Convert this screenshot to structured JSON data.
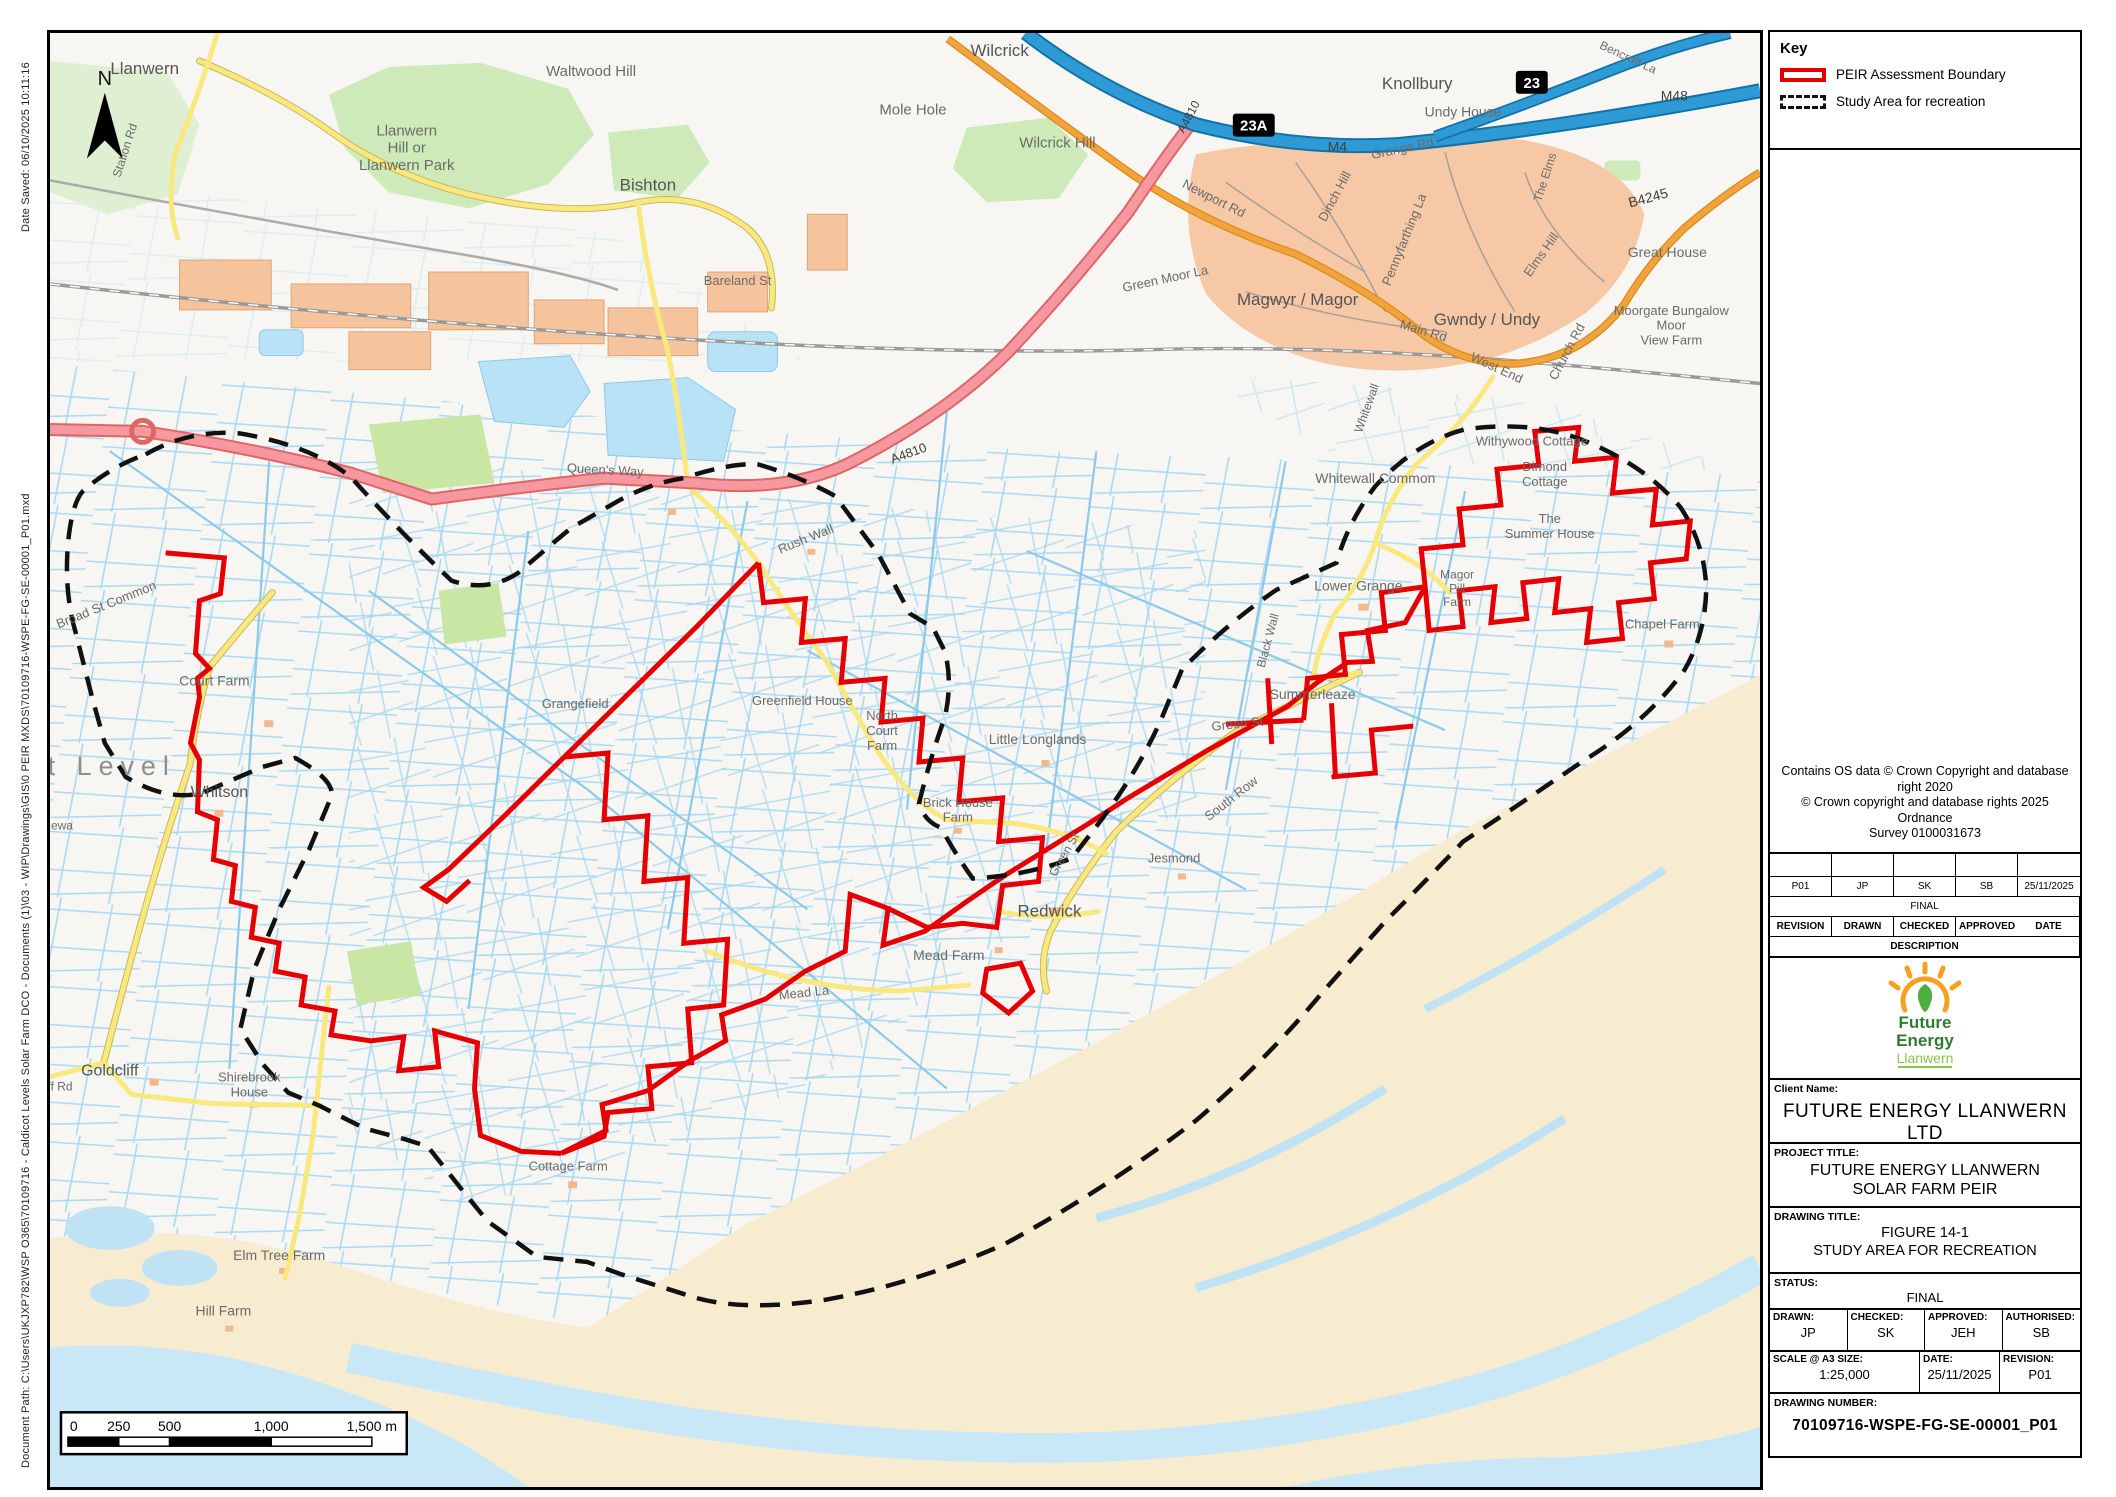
{
  "page": {
    "date_saved": "Date Saved: 06/10/2025 10:11:16",
    "document_path": "Document Path: C:\\Users\\UKJXP782\\WSP O365\\70109716 - Caldicot Levels Solar Farm DCO - Documents (1)\\03 - WIP\\Drawings\\GIS\\0 PEIR MXDS\\70109716-WSPE-FG-SE-00001_P01.mxd"
  },
  "north": "N",
  "key": {
    "title": "Key",
    "items": [
      {
        "label": "PEIR Assessment Boundary",
        "swatch": "red-solid"
      },
      {
        "label": "Study Area for recreation",
        "swatch": "black-dashed"
      }
    ]
  },
  "copyright": "Contains OS data © Crown Copyright and database\nright 2020\n© Crown copyright and database rights 2025 Ordnance\nSurvey 0100031673",
  "revision_table": {
    "empty_row": [
      "",
      "",
      "",
      "",
      ""
    ],
    "data_row": [
      "P01",
      "JP",
      "SK",
      "SB",
      "25/11/2025"
    ],
    "final_label": "FINAL",
    "headers": [
      "REVISION",
      "DRAWN",
      "CHECKED",
      "APPROVED",
      "DATE"
    ],
    "description_label": "DESCRIPTION"
  },
  "logo": {
    "line1": "Future",
    "line2": "Energy",
    "line3": "Llanwern"
  },
  "title_block": {
    "client_label": "Client Name:",
    "client_name": "FUTURE ENERGY LLANWERN LTD",
    "project_label": "PROJECT TITLE:",
    "project_title": "FUTURE ENERGY LLANWERN\nSOLAR FARM PEIR",
    "drawing_label": "DRAWING TITLE:",
    "drawing_title": "FIGURE 14-1\nSTUDY AREA FOR RECREATION",
    "status_label": "STATUS:",
    "status_value": "FINAL",
    "drawn_label": "DRAWN:",
    "drawn_value": "JP",
    "checked_label": "CHECKED:",
    "checked_value": "SK",
    "approved_label": "APPROVED:",
    "approved_value": "JEH",
    "authorised_label": "AUTHORISED:",
    "authorised_value": "SB",
    "scale_label": "SCALE @ A3 SIZE:",
    "scale_value": "1:25,000",
    "date_label": "DATE:",
    "date_value": "25/11/2025",
    "revision_label": "REVISION:",
    "revision_value": "P01",
    "drawing_number_label": "DRAWING NUMBER:",
    "drawing_number": "70109716-WSPE-FG-SE-00001_P01"
  },
  "scale_bar": {
    "ticks": [
      "0",
      "250",
      "500",
      "1,000",
      "1,500 m"
    ]
  },
  "colors": {
    "peir_boundary": "#e60004",
    "study_area": "#111111",
    "motorway": "#2e9bd6",
    "a_road": "#f598a0",
    "b_road": "#f2a33c",
    "minor_road": "#f9e87d",
    "water": "#a5d7f2",
    "sand": "#f8ecd0",
    "woodland": "#cdeab8",
    "builtup": "#f6c8a6"
  },
  "map": {
    "badges": [
      {
        "text": "23A",
        "x": 1208,
        "y": 93
      },
      {
        "text": "23",
        "x": 1487,
        "y": 50
      }
    ],
    "labels": [
      {
        "text": "Llanwern",
        "x": 95,
        "y": 41,
        "size": 17,
        "cls": "town"
      },
      {
        "text": "Station Rd",
        "x": 79,
        "y": 119,
        "size": 12,
        "rot": -72
      },
      {
        "text": "Waltwood Hill",
        "x": 543,
        "y": 43,
        "size": 15
      },
      {
        "text": "Llanwern\nHill or\nLlanwern Park",
        "x": 358,
        "y": 103,
        "size": 15
      },
      {
        "text": "Bishton",
        "x": 600,
        "y": 158,
        "size": 17,
        "cls": "town"
      },
      {
        "text": "Wilcrick",
        "x": 953,
        "y": 23,
        "size": 17,
        "cls": "town"
      },
      {
        "text": "Mole Hole",
        "x": 866,
        "y": 82,
        "size": 15
      },
      {
        "text": "Wilcrick Hill",
        "x": 1011,
        "y": 115,
        "size": 15
      },
      {
        "text": "Knollbury",
        "x": 1372,
        "y": 56,
        "size": 17,
        "cls": "town"
      },
      {
        "text": "Undy House",
        "x": 1418,
        "y": 84,
        "size": 14
      },
      {
        "text": "Bencroft La",
        "x": 1582,
        "y": 28,
        "size": 12,
        "rot": 25
      },
      {
        "text": "M48",
        "x": 1630,
        "y": 68,
        "size": 14,
        "cls": "roadnum"
      },
      {
        "text": "M4",
        "x": 1292,
        "y": 119,
        "size": 14,
        "cls": "roadnum"
      },
      {
        "text": "A4810",
        "x": 1146,
        "y": 86,
        "size": 12,
        "rot": -62,
        "cls": "roadnum"
      },
      {
        "text": "Newport Rd",
        "x": 1166,
        "y": 170,
        "size": 13,
        "rot": 27
      },
      {
        "text": "Grange Rd",
        "x": 1358,
        "y": 120,
        "size": 13,
        "rot": -12
      },
      {
        "text": "Dinch Hill",
        "x": 1293,
        "y": 166,
        "size": 13,
        "rot": -62
      },
      {
        "text": "Green Moor La",
        "x": 1120,
        "y": 251,
        "size": 13,
        "rot": -12
      },
      {
        "text": "Pennyfarthing La",
        "x": 1363,
        "y": 209,
        "size": 13,
        "rot": -68
      },
      {
        "text": "The Elms",
        "x": 1504,
        "y": 146,
        "size": 12,
        "rot": -72
      },
      {
        "text": "Elms Hill",
        "x": 1500,
        "y": 225,
        "size": 13,
        "rot": -55
      },
      {
        "text": "B4245",
        "x": 1605,
        "y": 170,
        "size": 14,
        "rot": -15,
        "cls": "roadnum"
      },
      {
        "text": "Great House",
        "x": 1623,
        "y": 225,
        "size": 14
      },
      {
        "text": "Magwyr / Magor",
        "x": 1252,
        "y": 273,
        "size": 17,
        "cls": "town"
      },
      {
        "text": "Main Rd",
        "x": 1377,
        "y": 303,
        "size": 13,
        "rot": 17
      },
      {
        "text": "Gwndy / Undy",
        "x": 1442,
        "y": 293,
        "size": 17,
        "cls": "town"
      },
      {
        "text": "West End",
        "x": 1450,
        "y": 340,
        "size": 13,
        "rot": 25
      },
      {
        "text": "Church Rd",
        "x": 1526,
        "y": 322,
        "size": 13,
        "rot": -62
      },
      {
        "text": "Moorgate Bungalow\nMoor\nView Farm",
        "x": 1627,
        "y": 283,
        "size": 13
      },
      {
        "text": "Whitewall",
        "x": 1325,
        "y": 378,
        "size": 12,
        "rot": -70
      },
      {
        "text": "Whitewall Common",
        "x": 1330,
        "y": 452,
        "size": 14
      },
      {
        "text": "Withywood Cottage",
        "x": 1487,
        "y": 414,
        "size": 13
      },
      {
        "text": "Dimond\nCottage",
        "x": 1500,
        "y": 440,
        "size": 13
      },
      {
        "text": "The\nSummer House",
        "x": 1505,
        "y": 492,
        "size": 13
      },
      {
        "text": "Magor\nPill\nFarm",
        "x": 1412,
        "y": 548,
        "size": 12
      },
      {
        "text": "Lower Grange",
        "x": 1313,
        "y": 560,
        "size": 14
      },
      {
        "text": "Chapel Farm",
        "x": 1618,
        "y": 598,
        "size": 13
      },
      {
        "text": "Black Wall",
        "x": 1226,
        "y": 611,
        "size": 12,
        "rot": -75
      },
      {
        "text": "Summerleaze",
        "x": 1267,
        "y": 669,
        "size": 14
      },
      {
        "text": "Green St",
        "x": 1192,
        "y": 698,
        "size": 13,
        "rot": -6
      },
      {
        "text": "Little Longlands",
        "x": 991,
        "y": 714,
        "size": 14
      },
      {
        "text": "North\nCourt\nFarm",
        "x": 835,
        "y": 690,
        "size": 13
      },
      {
        "text": "Greenfield House",
        "x": 755,
        "y": 675,
        "size": 13
      },
      {
        "text": "Brick House\nFarm",
        "x": 911,
        "y": 777,
        "size": 13
      },
      {
        "text": "Grangefield",
        "x": 527,
        "y": 678,
        "size": 13
      },
      {
        "text": "Rush Wall",
        "x": 760,
        "y": 512,
        "size": 13,
        "rot": -22
      },
      {
        "text": "Queen's Way",
        "x": 557,
        "y": 443,
        "size": 13,
        "rot": 3
      },
      {
        "text": "A4810",
        "x": 863,
        "y": 426,
        "size": 13,
        "rot": -20,
        "cls": "roadnum"
      },
      {
        "text": "Bareland St",
        "x": 690,
        "y": 253,
        "size": 13
      },
      {
        "text": "Redwick",
        "x": 1003,
        "y": 887,
        "size": 17,
        "cls": "town"
      },
      {
        "text": "Green St",
        "x": 1021,
        "y": 827,
        "size": 12,
        "rot": -60
      },
      {
        "text": "Jesmond",
        "x": 1128,
        "y": 833,
        "size": 13
      },
      {
        "text": "South Row",
        "x": 1188,
        "y": 772,
        "size": 13,
        "rot": -38
      },
      {
        "text": "Mead Farm",
        "x": 902,
        "y": 931,
        "size": 14
      },
      {
        "text": "Mead La",
        "x": 757,
        "y": 968,
        "size": 13,
        "rot": -6
      },
      {
        "text": "Court Farm",
        "x": 165,
        "y": 655,
        "size": 14
      },
      {
        "text": "Whitson",
        "x": 170,
        "y": 767,
        "size": 16,
        "cls": "town"
      },
      {
        "text": "Broad St Common",
        "x": 58,
        "y": 578,
        "size": 13,
        "rot": -22
      },
      {
        "text": "t Level",
        "x": 62,
        "y": 745,
        "size": 27,
        "cls": "big"
      },
      {
        "text": "ewa",
        "x": 12,
        "y": 800,
        "size": 12
      },
      {
        "text": "Goldcliff",
        "x": 60,
        "y": 1047,
        "size": 16,
        "cls": "town"
      },
      {
        "text": "ff Rd",
        "x": 10,
        "y": 1062,
        "size": 12
      },
      {
        "text": "Shirebrook\nHouse",
        "x": 200,
        "y": 1053,
        "size": 13
      },
      {
        "text": "Elm Tree Farm",
        "x": 230,
        "y": 1232,
        "size": 14
      },
      {
        "text": "Hill Farm",
        "x": 174,
        "y": 1288,
        "size": 14
      },
      {
        "text": "Cottage Farm",
        "x": 520,
        "y": 1142,
        "size": 13
      }
    ]
  }
}
